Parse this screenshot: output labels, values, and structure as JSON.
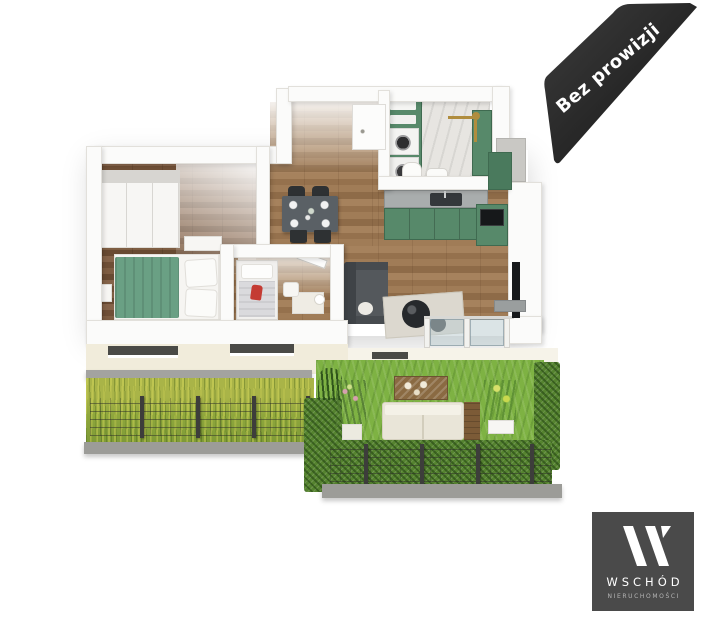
{
  "ribbon": {
    "label": "Bez prowizji",
    "bg": "#262626",
    "text_color": "#ffffff"
  },
  "logo": {
    "monogram": "W",
    "name": "WSCHÓD",
    "subtitle": "NIERUCHOMOŚCI",
    "bg": "#4a4a4a",
    "text_color": "#ffffff",
    "subtitle_color": "#b5b5b5"
  },
  "palette": {
    "accent_green": "#57896a",
    "bed_green": "#6aa084",
    "wood_floor": "#9a7854",
    "bedroom_floor": "#7a5a41",
    "grass_left": "#95a83d",
    "lawn_right": "#7eb243",
    "hedge_green": "#55832f",
    "concrete_gray": "#a3a3a0",
    "facade_cream": "#f1ecdb",
    "gold_fixture": "#b08d3e",
    "red_accent": "#c43b33"
  }
}
